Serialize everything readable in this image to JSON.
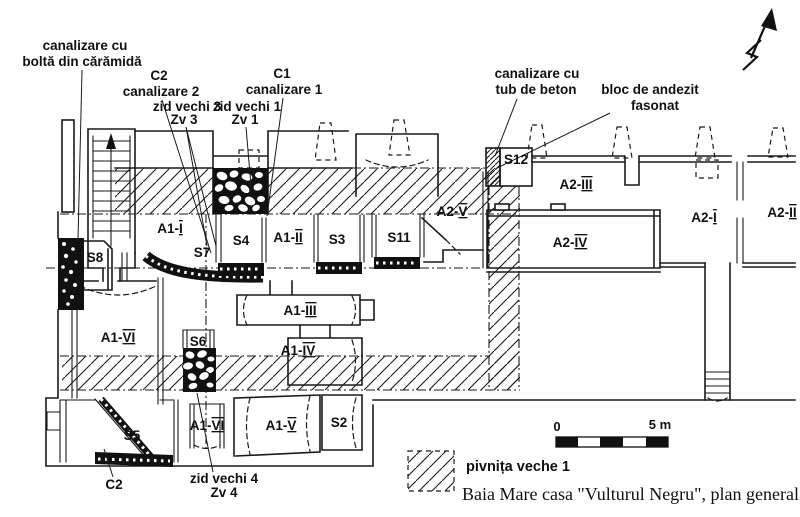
{
  "figure": {
    "caption": "Baia Mare casa \"Vulturul Negru\", plan general.",
    "legend_label": "pivnița veche 1",
    "scale": {
      "zero": "0",
      "five": "5 m"
    }
  },
  "callouts": {
    "canal_bolta": {
      "l1": "canalizare cu",
      "l2": "boltă din cărămidă"
    },
    "c2_top": {
      "l1": "C2",
      "l2": "canalizare 2"
    },
    "c1_top": {
      "l1": "C1",
      "l2": "canalizare 1"
    },
    "zv3": {
      "l1": "zid vechi 3",
      "l2": "Zv 3"
    },
    "zv1": {
      "l1": "zid vechi 1",
      "l2": "Zv 1"
    },
    "tub_beton": {
      "l1": "canalizare cu",
      "l2": "tub de beton"
    },
    "andezit": {
      "l1": "bloc de andezit",
      "l2": "fasonat"
    },
    "c2_bottom": {
      "l1": "C2"
    },
    "zv4": {
      "l1": "zid vechi 4",
      "l2": "Zv 4"
    }
  },
  "rooms": {
    "a1_1": {
      "p": "A1-",
      "n": "I"
    },
    "a1_2": {
      "p": "A1-",
      "n": "II"
    },
    "a1_3": {
      "p": "A1-",
      "n": "III"
    },
    "a1_4": {
      "p": "A1-",
      "n": "IV"
    },
    "a1_5": {
      "p": "A1-",
      "n": "V"
    },
    "a1_6": {
      "p": "A1-",
      "n": "VI"
    },
    "a1_6b": {
      "p": "A1-",
      "n": "VI"
    },
    "a2_1": {
      "p": "A2-",
      "n": "I"
    },
    "a2_2": {
      "p": "A2-",
      "n": "II"
    },
    "a2_3": {
      "p": "A2-",
      "n": "III"
    },
    "a2_4": {
      "p": "A2-",
      "n": "IV"
    },
    "a2_5": {
      "p": "A2-",
      "n": "V"
    },
    "s2": "S2",
    "s3": "S3",
    "s4": "S4",
    "s5": "S5",
    "s6": "S6",
    "s7": "S7",
    "s8": "S8",
    "s11": "S11",
    "s12": "S12"
  },
  "colors": {
    "ink": "#1a1a1a",
    "paper": "#ffffff"
  }
}
